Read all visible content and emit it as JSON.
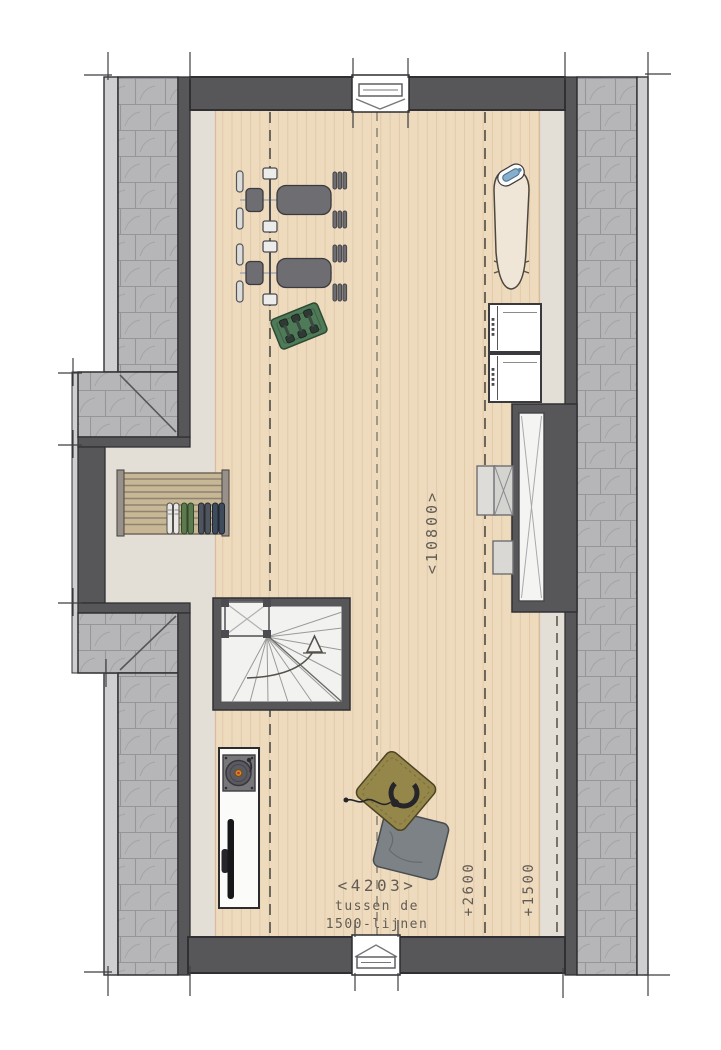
{
  "labels": {
    "length_dimension": "<10800>",
    "width_dimension": "<4203>",
    "width_note_line1": "tussen de",
    "width_note_line2": "1500-lijnen",
    "height_line_2600": "+2600",
    "height_line_1500": "+1500"
  },
  "objects": {
    "inventory": [
      "weight-bench-with-barbell (2x)",
      "dumbbell-rack",
      "roof-window-top-wall",
      "roof-window-bottom-wall",
      "ironing-board-with-iron",
      "stacked-laundry-machines (2x)",
      "built-in-wardrobe-cross-braced",
      "ventilation-unit",
      "equipment-boxes",
      "drying-rack-with-four-pairs-of-shoes",
      "winder-staircase-with-up-arrow",
      "sideboard-with-record-player",
      "tv-on-sideboard",
      "olive-floor-cushion-with-headphones",
      "grey-floor-cushion"
    ]
  },
  "colors": {
    "wall": "#57575a",
    "outline": "#303034",
    "tile": "#b6b6b8",
    "tileline": "#96969a",
    "tilearc": "#a4a4a7",
    "fascia": "#cfcfd2",
    "greige": "#e3ded6",
    "wood": "#eedabd",
    "woodline": "#d6bc9b",
    "dash": "#6e675c",
    "ridge": "#8a8274",
    "tick": "#3f3f42",
    "text": "#615c54",
    "stairFloor": "#f2f2f0",
    "closetInner": "#f4f4f2",
    "bench": "#6e6e72",
    "green": "#4f7a58",
    "olive": "#95874a",
    "grayCushion": "#7d8286",
    "rack": "#c8b795"
  }
}
